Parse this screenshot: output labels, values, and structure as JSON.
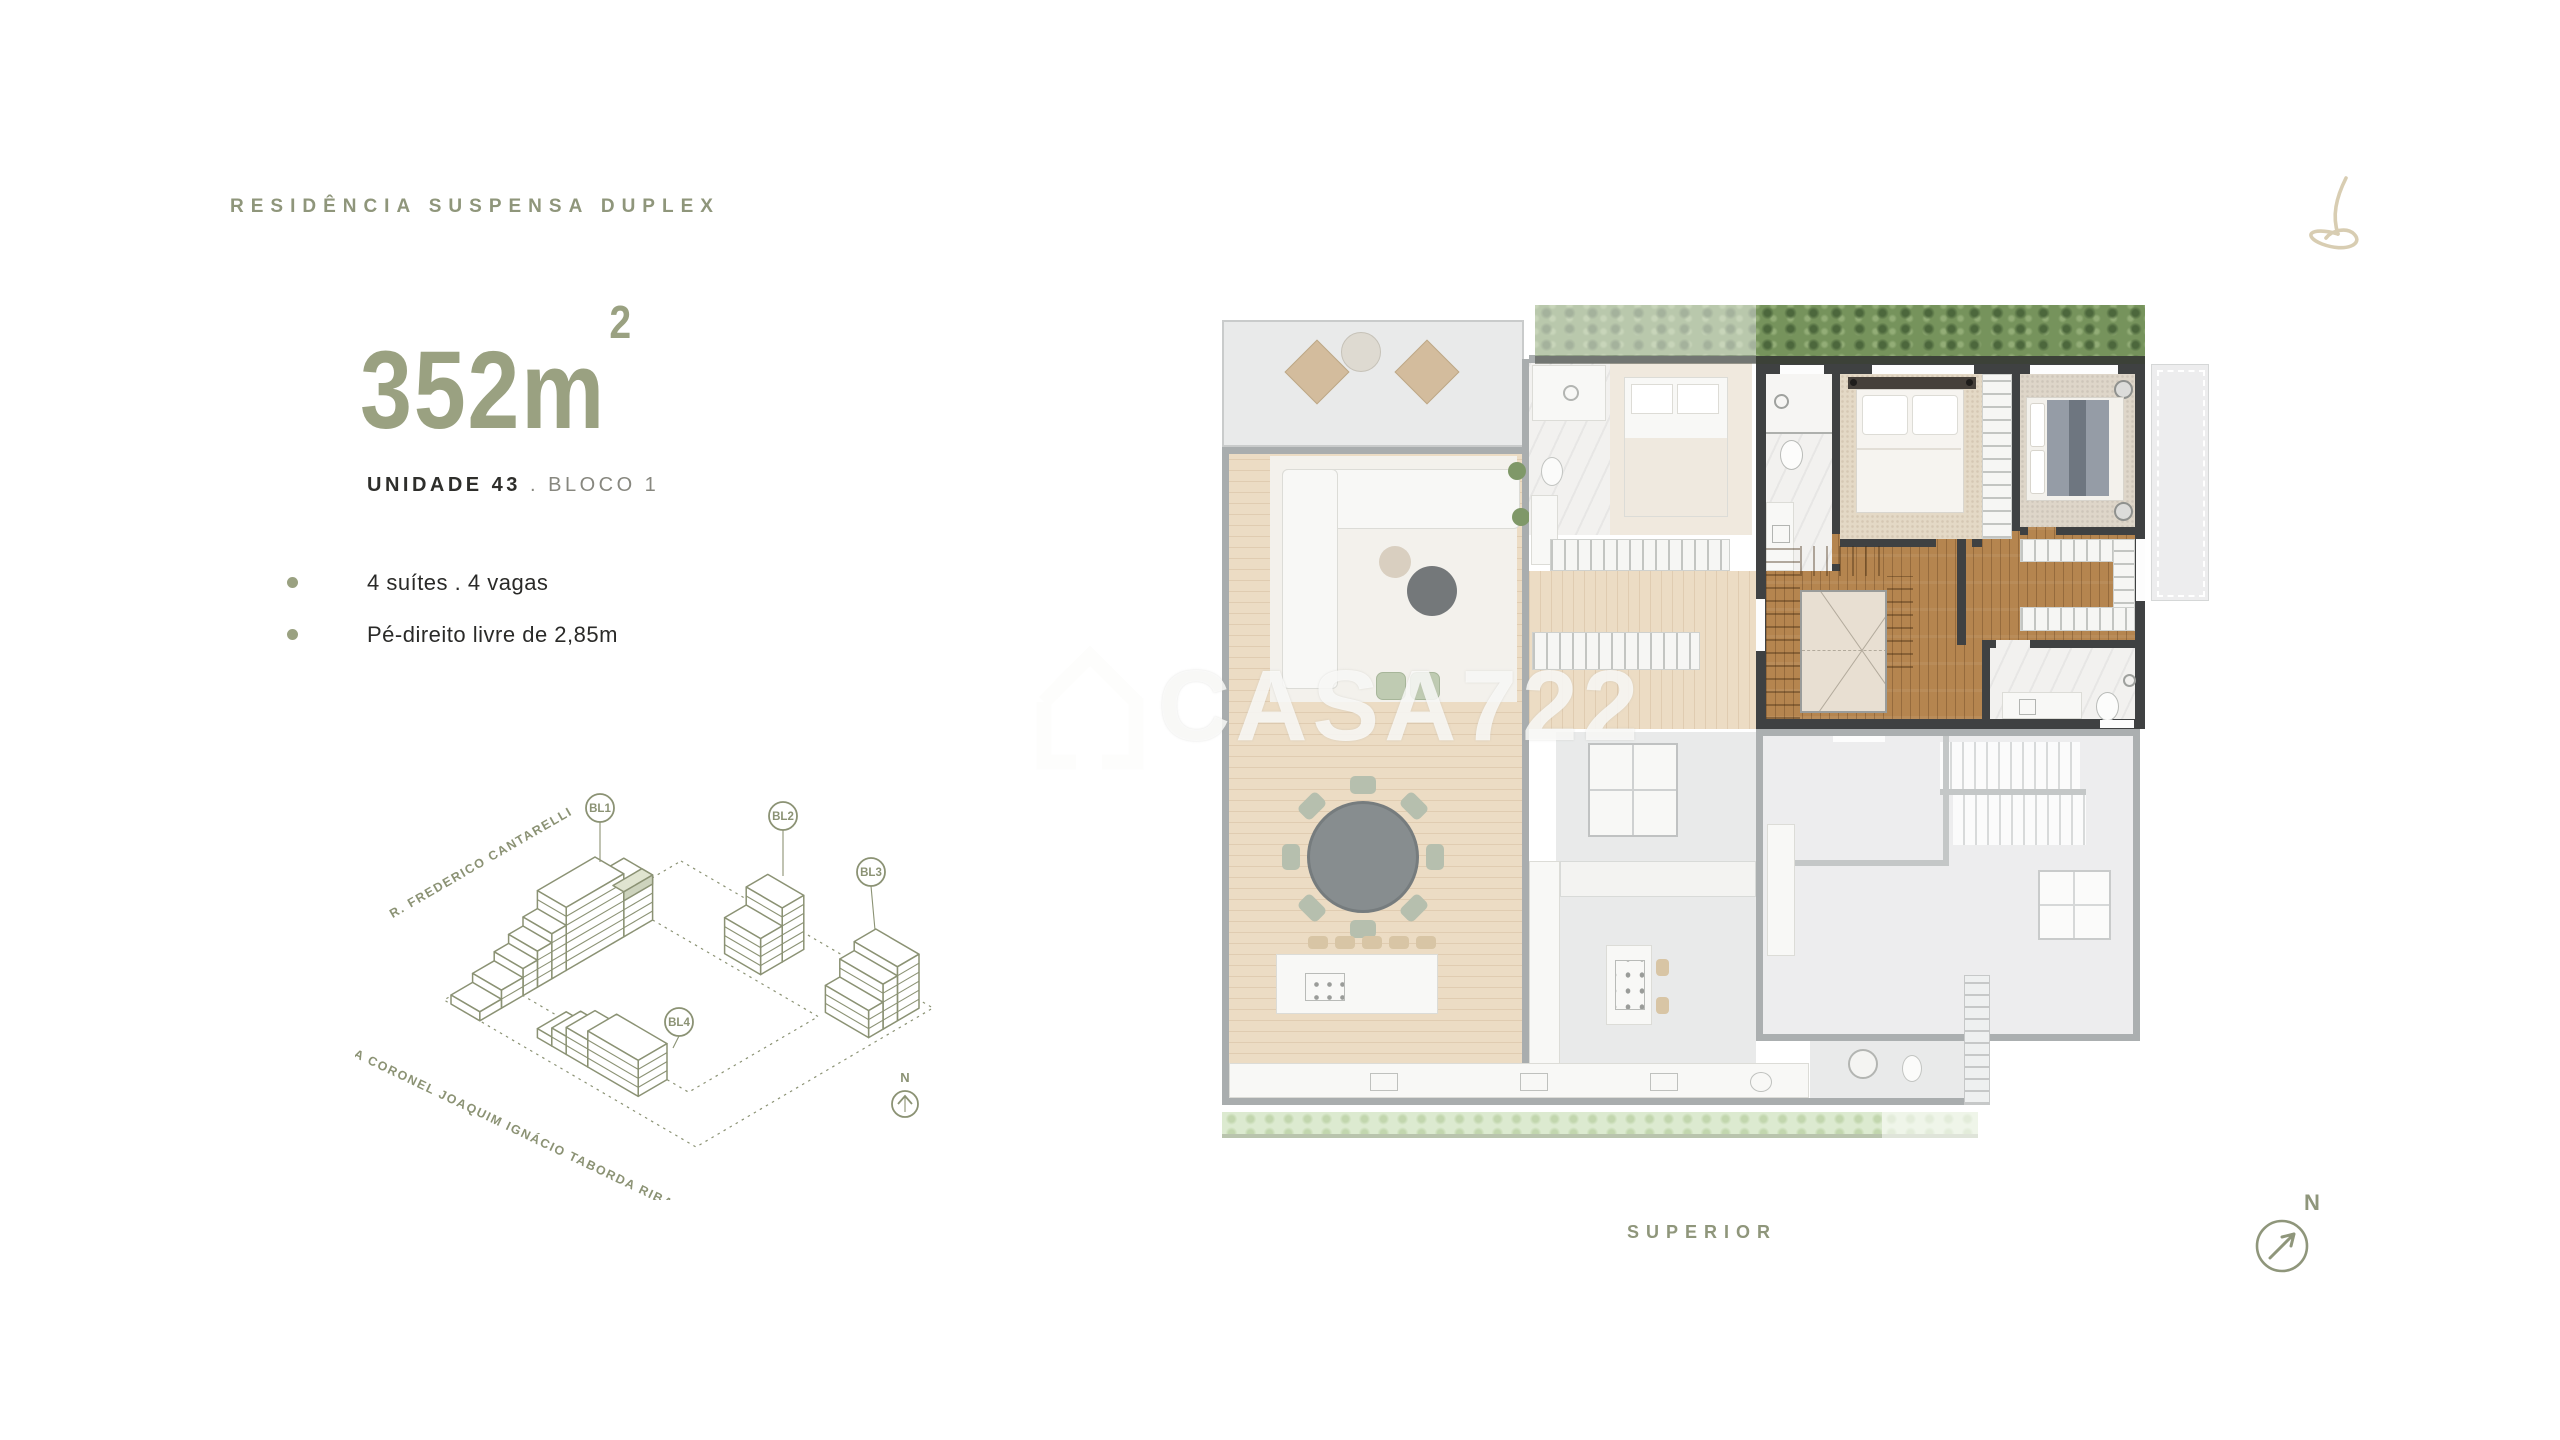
{
  "header": {
    "title": "RESIDÊNCIA SUSPENSA DUPLEX"
  },
  "info": {
    "area_value": "352",
    "area_unit": "m",
    "area_sup": "2",
    "unit_name": "UNIDADE 43",
    "separator": ".",
    "block_name": "BLOCO 1",
    "features": [
      {
        "text": "4 suítes .  4 vagas"
      },
      {
        "text": "Pé-direito livre de 2,85m"
      }
    ]
  },
  "site_diagram": {
    "blocks": [
      {
        "label": "BL1"
      },
      {
        "label": "BL2"
      },
      {
        "label": "BL3"
      },
      {
        "label": "BL4"
      }
    ],
    "streets": [
      {
        "name": "R. FREDERICO CANTARELLI"
      },
      {
        "name": "RUA CORONEL JOAQUIM IGNÁCIO TABORDA RIBAS"
      }
    ],
    "north_letter": "N"
  },
  "watermark": {
    "text": "CASA722"
  },
  "floorplan": {
    "level_label": "SUPERIOR"
  },
  "compass": {
    "letter": "N"
  },
  "colors": {
    "accent_green": "#8f967b",
    "number_green": "#9aa181",
    "dark_text": "#2e2e2b",
    "wall_dark": "#3f4142",
    "wood": "#b5854f",
    "highlight_unit_fill": "#cdd3bd",
    "grass": "#76935c"
  }
}
